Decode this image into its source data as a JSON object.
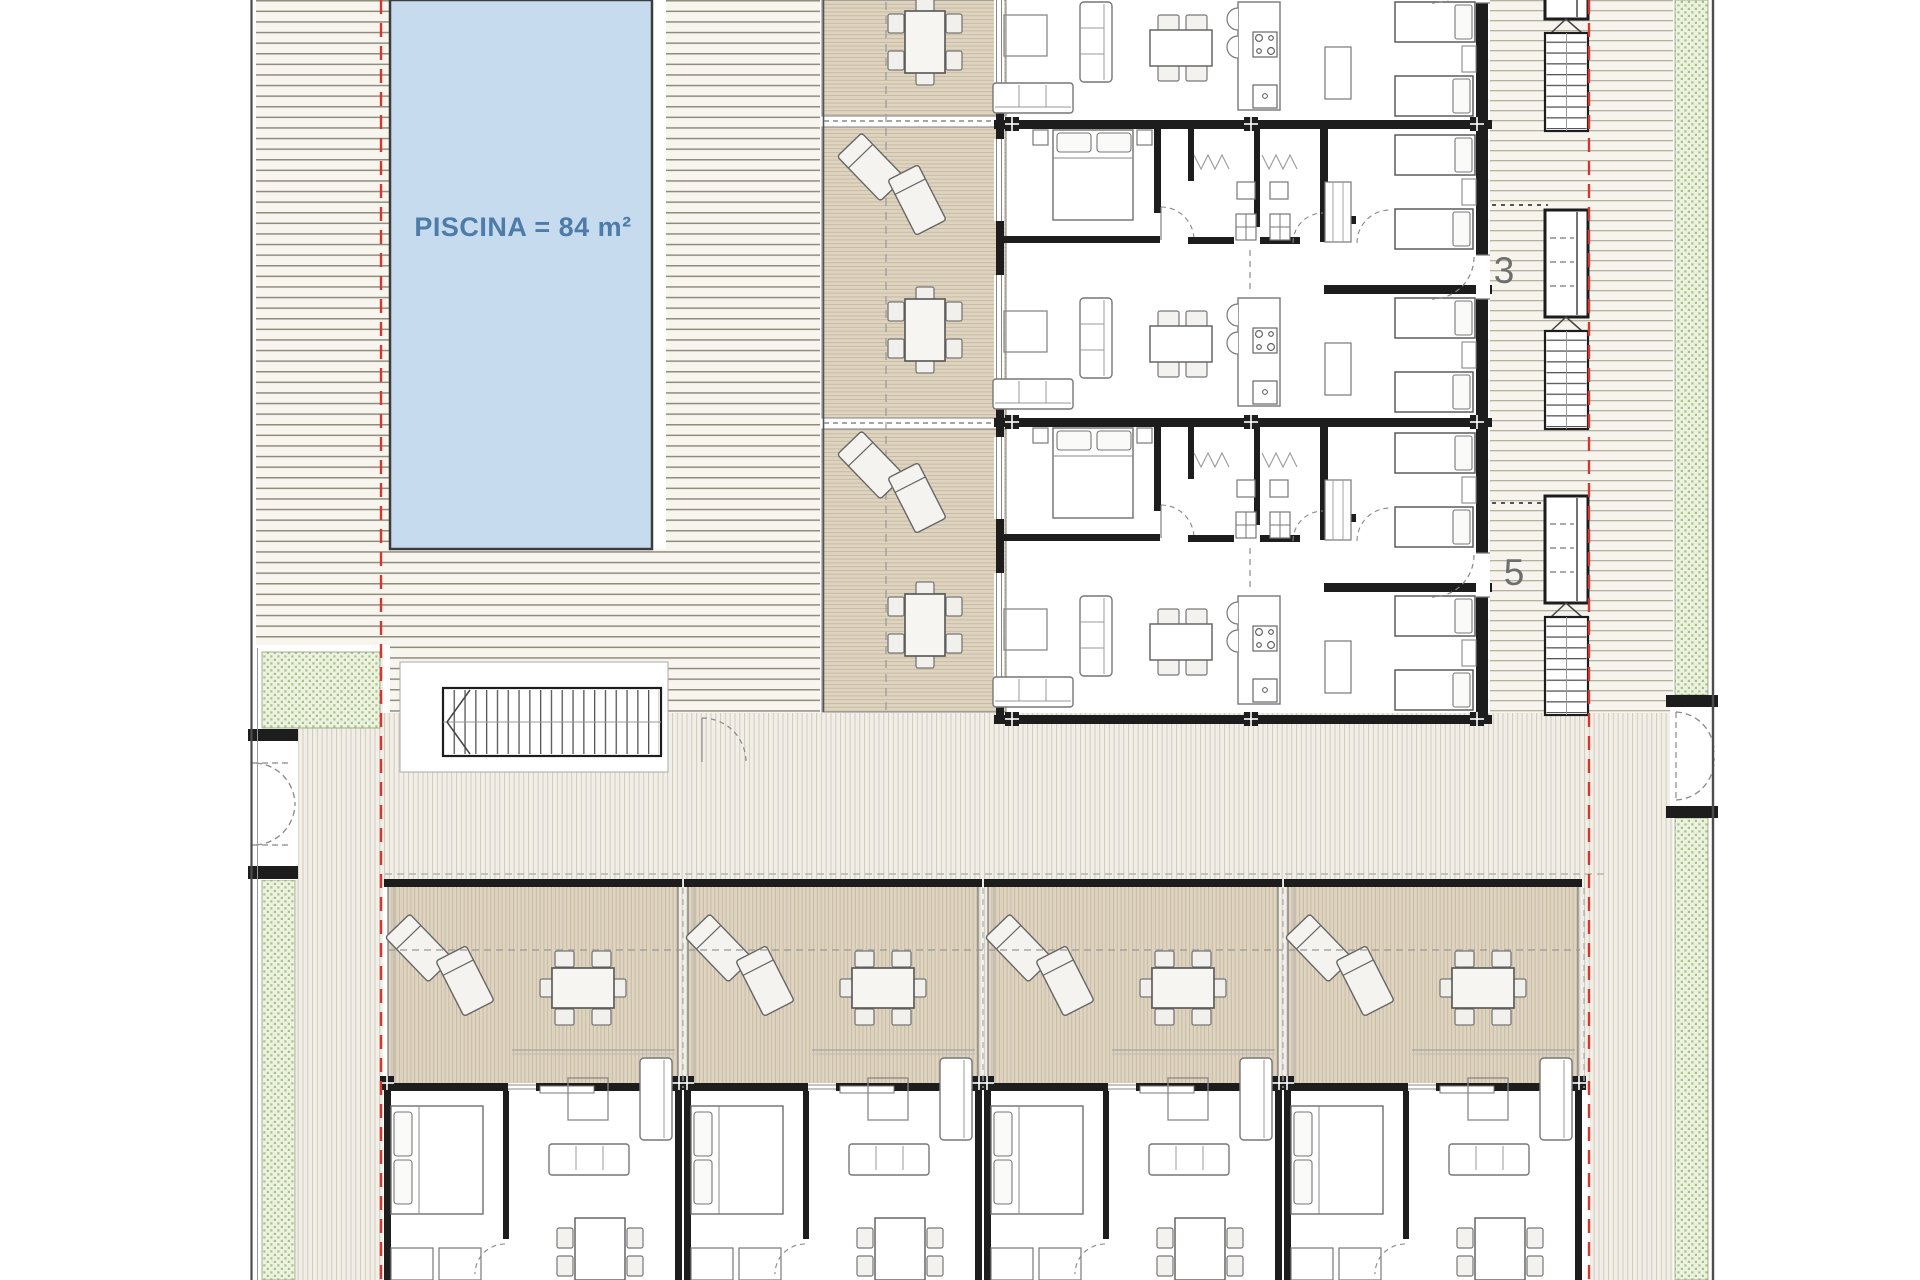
{
  "pool": {
    "label": "PISCINA = 84 m²",
    "fill": "#c7dbee",
    "label_color": "#4d7ca9"
  },
  "unit_markers": {
    "upper": "3",
    "lower": "5",
    "color": "#6e6e6e"
  },
  "boundary": {
    "red": "#d2392e"
  },
  "zones": {
    "terrace_fill": "#ded4c1",
    "deck_line": "#8f8b7d",
    "green_fill": "#edf2e0",
    "wall": "#1d1d1d"
  }
}
